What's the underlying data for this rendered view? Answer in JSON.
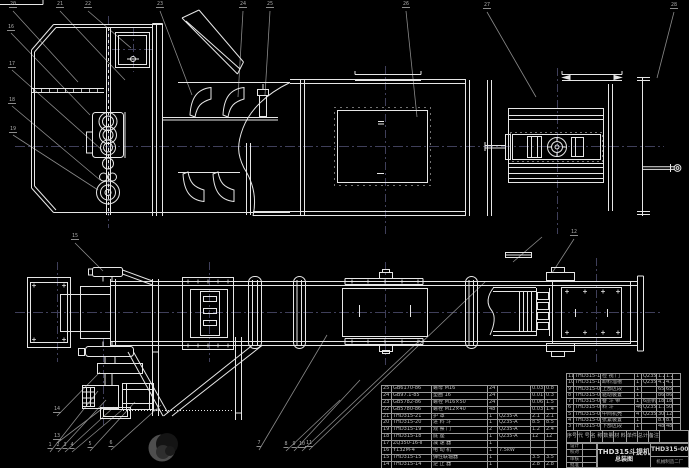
{
  "colors": {
    "background": "#000000",
    "drawing_line": "#e6e6e6",
    "leader_line": "#8a8a8a",
    "centerline": "#3f3f5a",
    "table_line": "#9a9a9a"
  },
  "title_block": {
    "drawing_title_line1": "THD315斗提机",
    "drawing_title_line2": "总装图",
    "drawing_number": "THD315-00",
    "company": "机械制造二厂",
    "sign_labels": [
      "设计",
      "校对",
      "审核",
      "批准"
    ]
  },
  "bom_right": {
    "header": [
      "序号",
      "代 号",
      "名 称",
      "数量",
      "材 料",
      "单件",
      "总计",
      "备注"
    ],
    "rows": [
      [
        "11",
        "THD315-11",
        "检 视 门",
        "1",
        "Q235-A",
        "1.2",
        "1.2",
        ""
      ],
      [
        "10",
        "THD315-10",
        "卸料溜槽",
        "1",
        "Q235-A",
        "4.2",
        "4.2",
        ""
      ],
      [
        "9",
        "THD315-09",
        "上部区段",
        "1",
        "",
        "65",
        "65",
        ""
      ],
      [
        "8",
        "THD315-08",
        "驱动装置",
        "1",
        "",
        "86",
        "86",
        ""
      ],
      [
        "7",
        "THD315-07",
        "畚 斗 带",
        "1",
        "6层帆布",
        "18",
        "18",
        ""
      ],
      [
        "6",
        "THD315-06",
        "料  斗",
        "46",
        "Q235-A",
        "1.1",
        "50.6",
        ""
      ],
      [
        "5",
        "THD315-05",
        "中间机壳",
        "4",
        "Q235-A",
        "30",
        "120",
        ""
      ],
      [
        "4",
        "THD315-04",
        "张紧装置",
        "1",
        "",
        "8.6",
        "8.6",
        ""
      ],
      [
        "3",
        "THD315-03",
        "下部区段",
        "1",
        "",
        "48",
        "48",
        ""
      ]
    ]
  },
  "bom_left": {
    "rows": [
      [
        "25",
        "GB6170-86",
        "螺母 M16",
        "24",
        "",
        "0.03",
        "0.8"
      ],
      [
        "24",
        "GB97.1-85",
        "垫圈 16",
        "24",
        "",
        "0.01",
        "0.3"
      ],
      [
        "23",
        "GB5782-86",
        "螺栓 M16×50",
        "24",
        "",
        "0.06",
        "1.5"
      ],
      [
        "22",
        "GB5780-86",
        "螺栓 M12×40",
        "48",
        "",
        "0.03",
        "1.4"
      ],
      [
        "21",
        "THD315-21",
        "护  罩",
        "1",
        "Q235-A",
        "2.1",
        "2.1"
      ],
      [
        "20",
        "THD315-20",
        "进 料 斗",
        "1",
        "Q235-A",
        "8.5",
        "8.5"
      ],
      [
        "19",
        "THD315-19",
        "观 察 门",
        "2",
        "Q235-A",
        "1.2",
        "2.4"
      ],
      [
        "18",
        "THD315-18",
        "底  座",
        "1",
        "Q235-A",
        "12",
        "12"
      ],
      [
        "17",
        "ZQ350-16-Ⅱ",
        "减 速 器",
        "1",
        "",
        "",
        ""
      ],
      [
        "16",
        "Y132M-4",
        "电 动 机",
        "1",
        "7.5kW",
        "",
        ""
      ],
      [
        "15",
        "THD315-15",
        "弹性联轴器",
        "1",
        "",
        "3.5",
        "3.5"
      ],
      [
        "14",
        "THD315-14",
        "逆 止 器",
        "1",
        "",
        "2.8",
        "2.8"
      ]
    ]
  },
  "balloons": {
    "items": [
      {
        "x": 13,
        "y": 8,
        "t": "20"
      },
      {
        "x": 60,
        "y": 8,
        "t": "21"
      },
      {
        "x": 88,
        "y": 8,
        "t": "22"
      },
      {
        "x": 160,
        "y": 8,
        "t": "23"
      },
      {
        "x": 243,
        "y": 8,
        "t": "24"
      },
      {
        "x": 270,
        "y": 8,
        "t": "25"
      },
      {
        "x": 406,
        "y": 8,
        "t": "26"
      },
      {
        "x": 487,
        "y": 9,
        "t": "27"
      },
      {
        "x": 674,
        "y": 9,
        "t": "28"
      },
      {
        "x": 11,
        "y": 31,
        "t": "16"
      },
      {
        "x": 12,
        "y": 68,
        "t": "17"
      },
      {
        "x": 12,
        "y": 104,
        "t": "18"
      },
      {
        "x": 13,
        "y": 133,
        "t": "19"
      },
      {
        "x": 75,
        "y": 240,
        "t": "15"
      },
      {
        "x": 57,
        "y": 413,
        "t": "14"
      },
      {
        "x": 57,
        "y": 440,
        "t": "13"
      },
      {
        "x": 50,
        "y": 449,
        "t": "1"
      },
      {
        "x": 58,
        "y": 449,
        "t": "2"
      },
      {
        "x": 65,
        "y": 449,
        "t": "3"
      },
      {
        "x": 72,
        "y": 449,
        "t": "4"
      },
      {
        "x": 90,
        "y": 448,
        "t": "5"
      },
      {
        "x": 111,
        "y": 447,
        "t": "6"
      },
      {
        "x": 259,
        "y": 447,
        "t": "7"
      },
      {
        "x": 286,
        "y": 448,
        "t": "8"
      },
      {
        "x": 294,
        "y": 448,
        "t": "9"
      },
      {
        "x": 302,
        "y": 448,
        "t": "10"
      },
      {
        "x": 309,
        "y": 447,
        "t": "11"
      },
      {
        "x": 574,
        "y": 236,
        "t": "12"
      }
    ]
  }
}
